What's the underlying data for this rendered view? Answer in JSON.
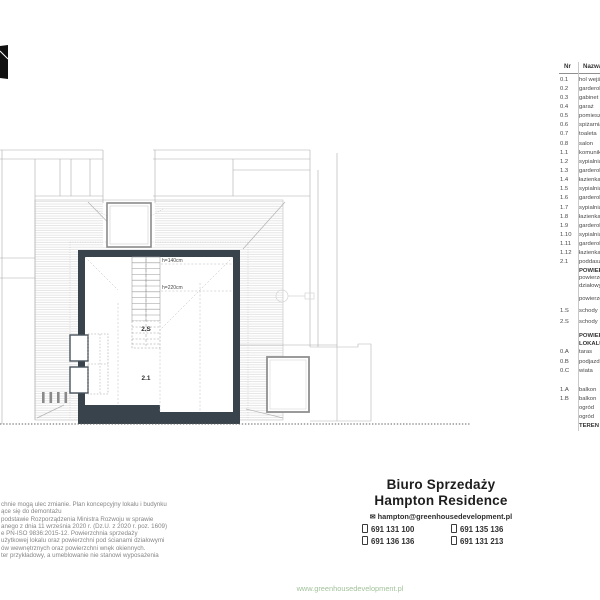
{
  "brand": {
    "url": "www.greenhousedevelopment.pl",
    "url_color": "#a2c29b"
  },
  "plan": {
    "wall_color": "#39434c",
    "labels": {
      "h140": "h=140cm",
      "h220": "h=220cm",
      "stairs_room": "2.S",
      "attic_room": "2.1"
    }
  },
  "room_table": {
    "headers": {
      "nr": "Nr",
      "name": "Nazwa"
    },
    "rows": [
      {
        "nr": "0.1",
        "name": "hol wejściowy"
      },
      {
        "nr": "0.2",
        "name": "garderoba"
      },
      {
        "nr": "0.3",
        "name": "gabinet"
      },
      {
        "nr": "0.4",
        "name": "garaż"
      },
      {
        "nr": "0.5",
        "name": "pomieszczenie"
      },
      {
        "nr": "0.6",
        "name": "spiżarnia"
      },
      {
        "nr": "0.7",
        "name": "toaleta"
      },
      {
        "nr": "0.8",
        "name": "salon"
      },
      {
        "nr": "1.1",
        "name": "komunikacja"
      },
      {
        "nr": "1.2",
        "name": "sypialnia"
      },
      {
        "nr": "1.3",
        "name": "garderoba"
      },
      {
        "nr": "1.4",
        "name": "łazienka"
      },
      {
        "nr": "1.5",
        "name": "sypialnia"
      },
      {
        "nr": "1.6",
        "name": "garderoba"
      },
      {
        "nr": "1.7",
        "name": "sypialnia"
      },
      {
        "nr": "1.8",
        "name": "łazienka"
      },
      {
        "nr": "1.9",
        "name": "garderoba"
      },
      {
        "nr": "1.10",
        "name": "sypialnia"
      },
      {
        "nr": "1.11",
        "name": "garderoba"
      },
      {
        "nr": "1.12",
        "name": "łazienka"
      },
      {
        "nr": "2.1",
        "name": "poddasze"
      },
      {
        "nr": "",
        "name": "POWIERZCHNIA",
        "bold": true,
        "tight": true
      },
      {
        "nr": "",
        "name": "powierzchnia",
        "tight": true
      },
      {
        "nr": "",
        "name": "działowymi",
        "tight": true
      },
      {
        "nr": "",
        "name": "powierzchnia",
        "tight": true,
        "gap_before": 5
      },
      {
        "nr": "1.S",
        "name": "schody",
        "gap_before": 4
      },
      {
        "nr": "2.S",
        "name": "schody",
        "gap_before": 2
      },
      {
        "nr": "",
        "name": "POWIERZCHNIE",
        "bold": true,
        "tight": true,
        "gap_before": 6
      },
      {
        "nr": "",
        "name": "LOKALU",
        "bold": true,
        "tight": true
      },
      {
        "nr": "0.A",
        "name": "taras"
      },
      {
        "nr": "0.B",
        "name": "podjazd"
      },
      {
        "nr": "0.C",
        "name": "wiata"
      },
      {
        "nr": "1.A",
        "name": "balkon",
        "gap_before": 10
      },
      {
        "nr": "1.B",
        "name": "balkon"
      },
      {
        "nr": "",
        "name": "ogród"
      },
      {
        "nr": "",
        "name": "ogród"
      },
      {
        "nr": "",
        "name": "TEREN",
        "bold": true
      }
    ]
  },
  "disclaimer": {
    "lines": [
      "chnie mogą ulec zmianie. Plan koncepcyjny lokalu i budynku",
      "ące się  do demontażu",
      "podstawie Rozporządzenia Ministra Rozwoju w sprawie",
      "anego z dnia 11 września 2020 r. (Dz.U. z 2020 r. poz. 1609)",
      "e PN-ISO 9836:2015-12. Powierzchnia sprzedaży",
      "użytkowej lokalu oraz powierzchni pod ścianami działowymi",
      "ów wewnętrznych oraz powierzchni wnęk okiennych.",
      "ter przykładowy, a umeblowanie nie stanowi wyposażenia"
    ]
  },
  "contact": {
    "title_line1": "Biuro Sprzedaży",
    "title_line2": "Hampton Residence",
    "email": "hampton@greenhousedevelopment.pl",
    "phones": [
      "691 131 100",
      "691 135 136",
      "691 136 136",
      "691 131 213"
    ]
  }
}
